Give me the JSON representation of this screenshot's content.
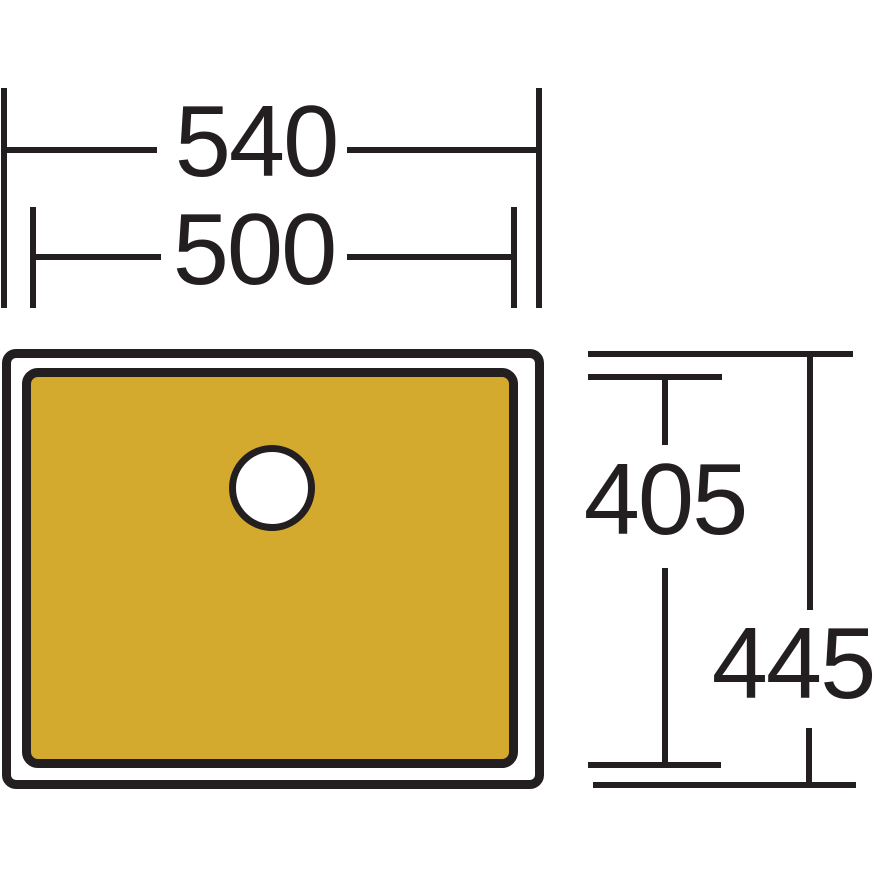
{
  "diagram": {
    "type": "sink-top-view-dimension-drawing",
    "dimensions": {
      "outer_width": "540",
      "inner_width": "500",
      "inner_height": "405",
      "outer_height": "445"
    },
    "colors": {
      "line": "#231F20",
      "bowl_fill": "#D3A92E",
      "drain_fill": "#FFFFFF",
      "background": "#FFFFFF"
    }
  }
}
